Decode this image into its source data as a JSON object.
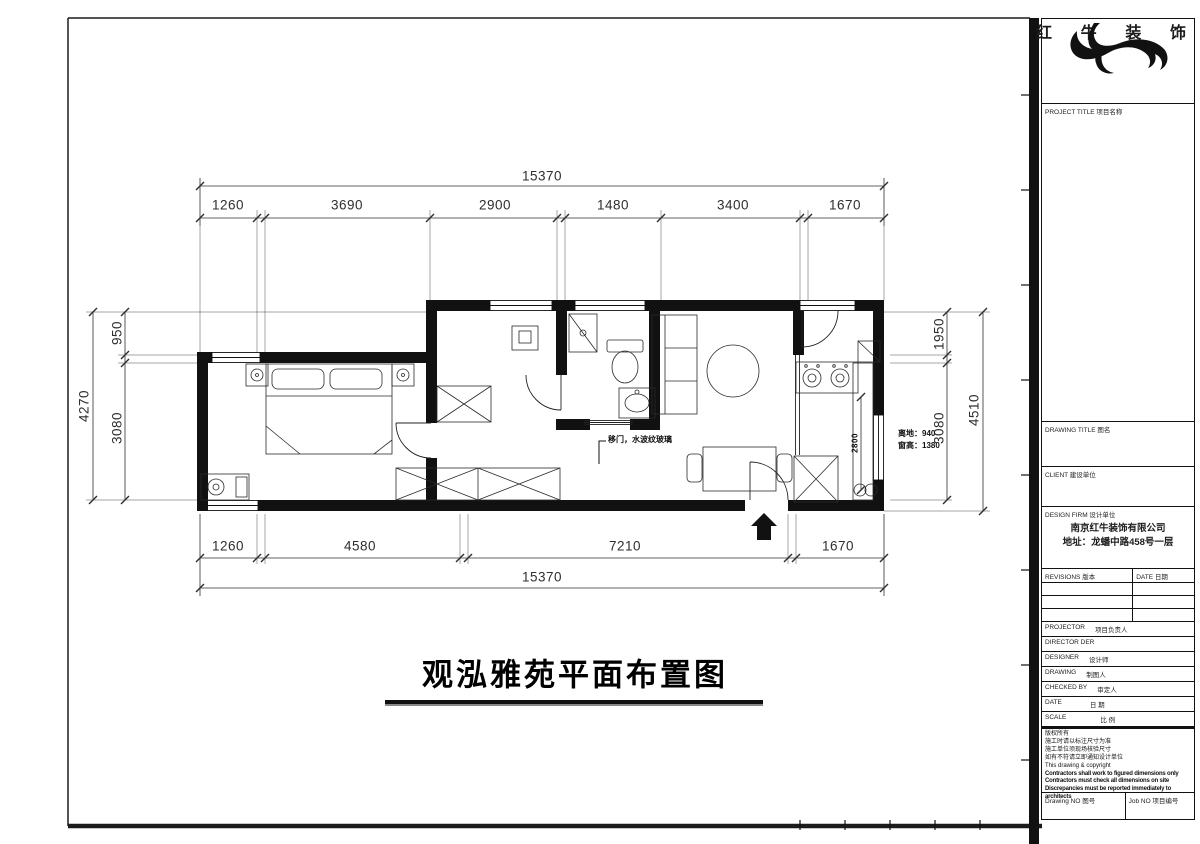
{
  "page": {
    "background": "#ffffff",
    "ink": "#1c1c1c"
  },
  "plan": {
    "title": "观泓雅苑平面布置图",
    "dims": {
      "top_total": "15370",
      "top_segments": [
        "1260",
        "3690",
        "2900",
        "1480",
        "3400",
        "1670"
      ],
      "bottom_segments": [
        "1260",
        "4580",
        "7210",
        "1670"
      ],
      "bottom_total": "15370",
      "left_total": "4270",
      "left_top": "950",
      "left_bottom": "3080",
      "right_top": "1950",
      "right_bottom": "3080",
      "right_total": "4510",
      "kitchen_counter": "2800"
    },
    "notes": {
      "glass_door": "移门，水波纹玻璃",
      "window_height_1": "离地：940",
      "window_height_2": "窗高：1380"
    }
  },
  "title_block": {
    "brand": "红牛装饰",
    "brand_chars": [
      "红",
      "牛",
      "装",
      "饰"
    ],
    "project_title_label": "PROJECT TITLE 项目名称",
    "drawing_title_label": "DRAWING TITLE 图名",
    "client_label": "CLIENT 建设单位",
    "design_firm_label": "DESIGN FIRM 设计单位",
    "company": "南京红牛装饰有限公司",
    "address": "地址：龙蟠中路458号一层",
    "revisions_label": "REVISIONS 版本",
    "rev_date_label": "DATE 日期",
    "staff_rows": [
      {
        "en": "PROJECTOR",
        "cn": "项目负责人"
      },
      {
        "en": "DIRECTOR DER",
        "cn": ""
      },
      {
        "en": "DESIGNER",
        "cn": "设计师"
      },
      {
        "en": "DRAWING",
        "cn": "制图人"
      },
      {
        "en": "CHECKED BY",
        "cn": "审定人"
      },
      {
        "en": "DATE",
        "cn": "日 期"
      },
      {
        "en": "SCALE",
        "cn": "比 例"
      }
    ],
    "notes": [
      "版权所有",
      "施工时请以标注尺寸为准",
      "施工单位须现场核验尺寸",
      "如有不符请立即通知设计单位",
      "This drawing & copyright",
      "Contractors shall work to figured dimensions only",
      "Contractors must check all dimensions on site",
      "Discrepancies must be reported immediately to architects"
    ],
    "drawing_no_label": "Drawing NO 图号",
    "job_no_label": "Job NO 项目编号"
  }
}
